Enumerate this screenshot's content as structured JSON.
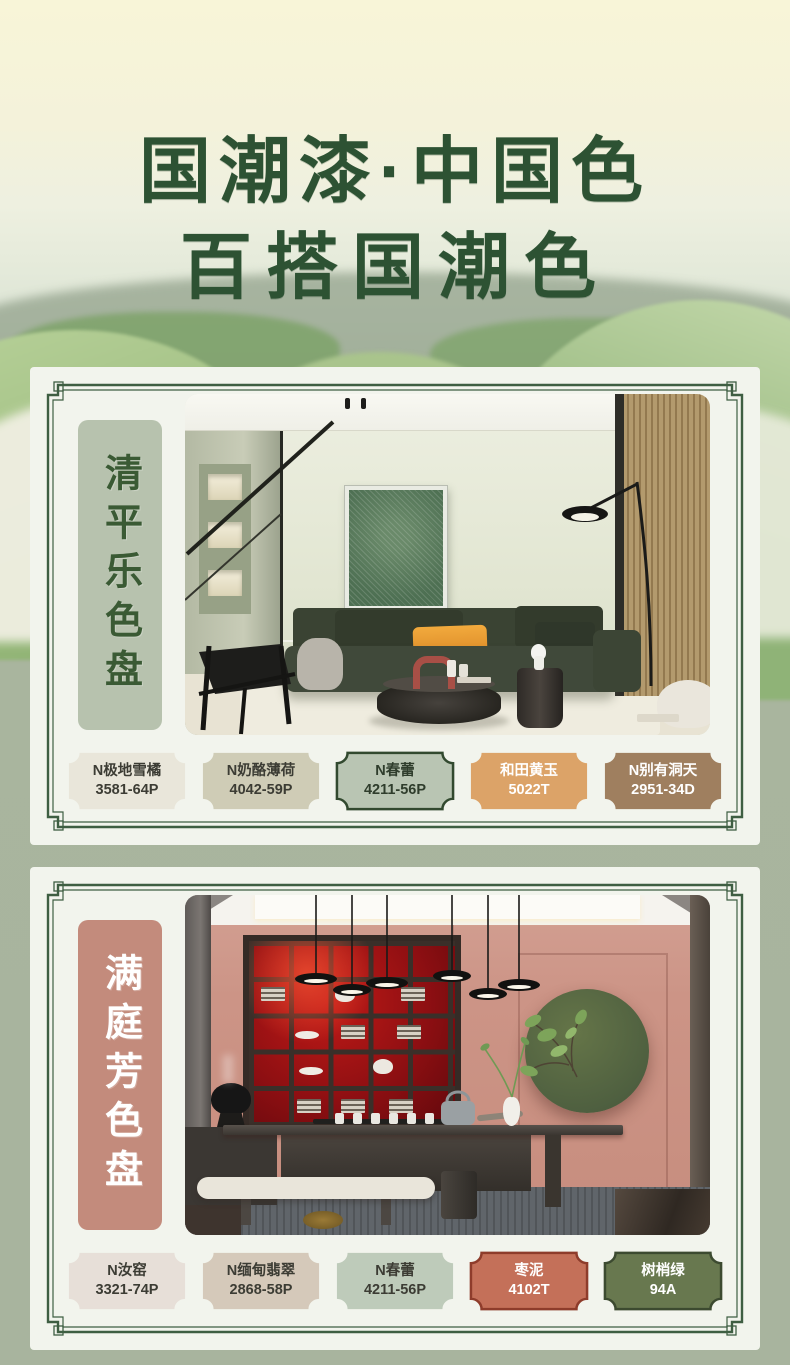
{
  "poster": {
    "title_line1": "国潮漆·中国色",
    "title_line2": "百搭国潮色"
  },
  "colors": {
    "title_green": "#2d5233",
    "frame_green": "#3e5e42",
    "background_sage": "#a8b49e",
    "card_bg": "#f2f4ed"
  },
  "palettes": [
    {
      "name": "清平乐色盘",
      "banner_bg": "#b7c2ae",
      "banner_text": "#3a5a34",
      "swatches": [
        {
          "name": "N极地雪橘",
          "code": "3581-64P",
          "fill": "#e9e6da",
          "border": null,
          "text": "#3c3c34"
        },
        {
          "name": "N奶酪薄荷",
          "code": "4042-59P",
          "fill": "#cfccb6",
          "border": null,
          "text": "#3c3c34"
        },
        {
          "name": "N春蕾",
          "code": "4211-56P",
          "fill": "#b9c5b3",
          "border": "#32492f",
          "text": "#2f3d2c"
        },
        {
          "name": "和田黄玉",
          "code": "5022T",
          "fill": "#dca368",
          "border": null,
          "text": "#ffffff"
        },
        {
          "name": "N别有洞天",
          "code": "2951-34D",
          "fill": "#9f7f5f",
          "border": null,
          "text": "#ffffff"
        }
      ]
    },
    {
      "name": "满庭芳色盘",
      "banner_bg": "#c38b7c",
      "banner_text": "#ffffff",
      "swatches": [
        {
          "name": "N汝窑",
          "code": "3321-74P",
          "fill": "#e7dfd8",
          "border": null,
          "text": "#3c3c34"
        },
        {
          "name": "N缅甸翡翠",
          "code": "2868-58P",
          "fill": "#d5c9ba",
          "border": null,
          "text": "#3c3c34"
        },
        {
          "name": "N春蕾",
          "code": "4211-56P",
          "fill": "#becbba",
          "border": null,
          "text": "#3c3c34"
        },
        {
          "name": "枣泥",
          "code": "4102T",
          "fill": "#c47059",
          "border": "#8e3c2b",
          "text": "#ffffff"
        },
        {
          "name": "树梢绿",
          "code": "94A",
          "fill": "#68784f",
          "border": "#3c4a30",
          "text": "#ffffff"
        }
      ]
    }
  ]
}
